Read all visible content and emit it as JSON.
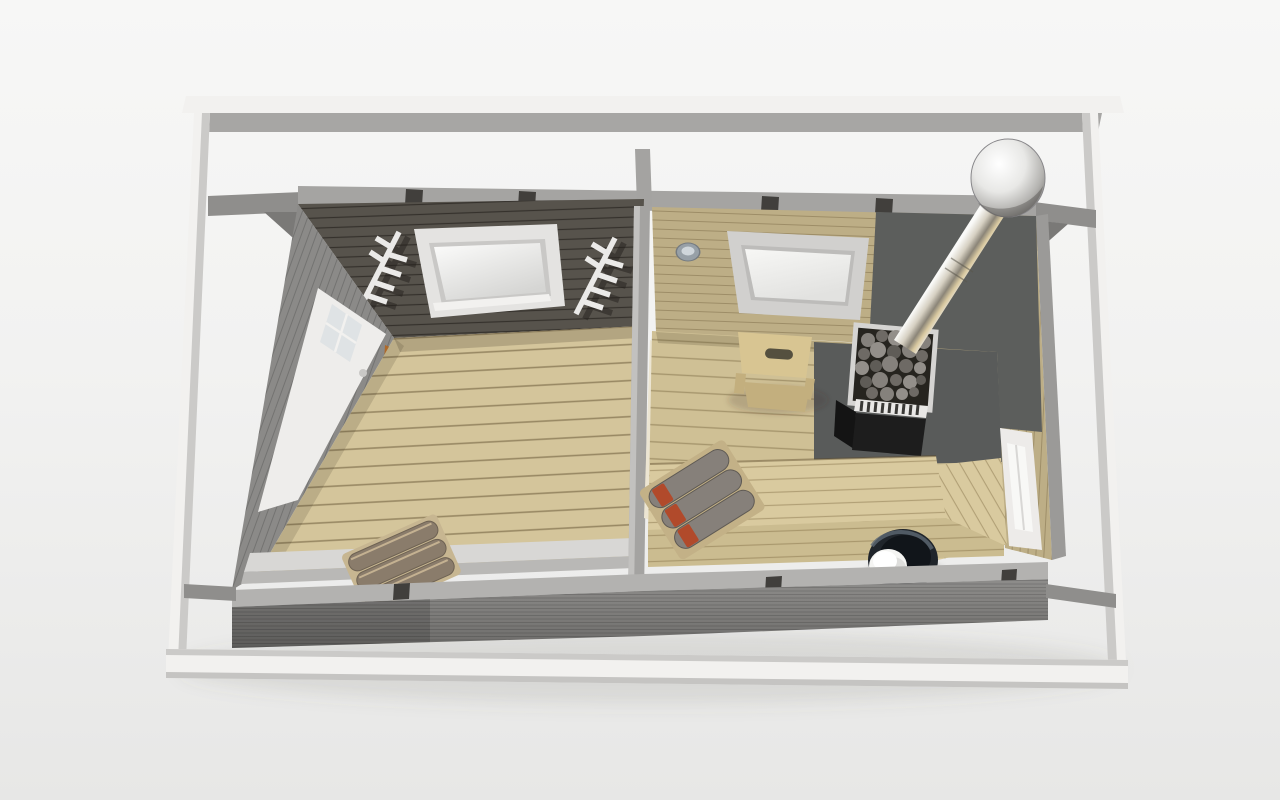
{
  "scene": {
    "subject": "3D cutaway top-down view of a two-room outdoor sauna cabin",
    "style": "photorealistic architectural render on a light studio backdrop",
    "structure": [
      "white-roof-frame",
      "gray-log-walls",
      "partition-wall"
    ],
    "rooms": [
      {
        "name": "dressing-room",
        "position": "left",
        "wall_finish": "gray painted wood",
        "items": [
          "entrance-door-with-window",
          "wall-skylight-window",
          "branch-coat-hooks",
          "white-bench",
          "rolled-towels",
          "plank-floor"
        ]
      },
      {
        "name": "sauna-room",
        "position": "right",
        "wall_finish": "natural wood",
        "items": [
          "wall-skylight-window",
          "recessed-ceiling-light",
          "two-tier-step-stool",
          "stove-with-stones",
          "stainless-chimney-with-rain-cap",
          "dark-heat-shield-corner",
          "l-shaped-benches",
          "striped-towels",
          "water-bucket-with-ladle-cup",
          "side-window",
          "partition-door"
        ]
      }
    ]
  },
  "palette": {
    "frame_white": "#f2f1ef",
    "frame_shade": "#cbcac8",
    "frame_under": "#a7a6a4",
    "purlin": "#8f8e8c",
    "purlin_dark": "#7a7977",
    "wall_edge": "#a5a4a2",
    "notch": "#413f3c",
    "divider": "#a4a3a1",
    "divider_hl": "#c2c1bf",
    "ceiling_dark": "#57534c",
    "siding": "#8b8a88",
    "door_white": "#eeedeb",
    "door_glass": "#dfe3e5",
    "jamb": "#ae6a2b",
    "floor_left": "#d4c59b",
    "bench_white": "#d8d7d5",
    "bench_white_front": "#b9b8b6",
    "towel_brown": "#8a7c6b",
    "towel_trim": "#c7b691",
    "mat_tan": "#c3b187",
    "bottom_top": "#b3b2b0",
    "bottom_front": "#858480",
    "sauna_wall": "#bdae86",
    "sauna_floor": "#cfc095",
    "shield": "#5c5e5c",
    "pad": "#595b5a",
    "sky_frame_left": "#e4e3e1",
    "sky_frame_sauna": "#d1d0ce",
    "stool": "#d8c592",
    "stool_side": "#c3af7e",
    "stove_body": "#1d1d1d",
    "vent": "#e9e8e6",
    "bench_wood": "#d9ca9f",
    "bench_wood_low": "#cbbc90",
    "towel_gray": "#86807a",
    "towel_red": "#b14a2b",
    "bucket_dark": "#20252b",
    "cup_white": "#f5f5f3",
    "win_frame": "#edebe9",
    "win_glass": "#f8f8f6",
    "door_cream": "#ece5d2",
    "wall_ext_right": "#9b9a98",
    "hook_white": "#ebeae8"
  }
}
